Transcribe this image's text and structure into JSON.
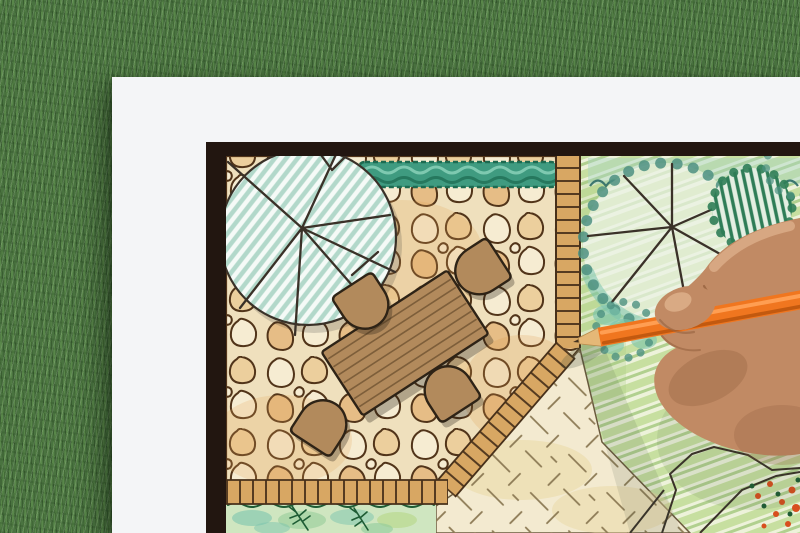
{
  "scene": {
    "subject": "hand drawing a backyard garden landscape architecture plan with an orange colored pencil",
    "setting": "white paper sheet lying on green grass lawn",
    "drawing_elements": {
      "tree_left": "large round tree symbol with teal hatching and branch lines",
      "hedge_top": "clipped hedge strip in teal green",
      "patio": "irregular flagstone patio",
      "furniture": "rectangular wooden table with four rounded chairs",
      "edging": "brick soldier-course edging bands around patio",
      "lawn_right": "striped colored-pencil lawn",
      "tree_right": "tree symbol with scalloped canopy and radiating branches",
      "shrub_right": "dark green hatched shrub symbol",
      "sand_area": "pale gravel area with diagonal tick marks",
      "bed_bottom": "planting bed with ferns",
      "flower_bed": "corner bed with small red-orange blooms"
    },
    "photo_props": {
      "pencil": "orange colored pencil",
      "hand": "right hand gripping pencil from the right edge"
    }
  },
  "colors": {
    "grass-base": "#4a7340",
    "paper": "#f4f5f7",
    "frame": "#221610",
    "plan-base": "#f8f3e2",
    "ink-brown": "#513419",
    "stone-cream": "#f6ecd2",
    "stone-tan": "#eccf9d",
    "stone-warm": "#e6bd86",
    "stone-grout": "#efe0bd",
    "wood": "#b28a5c",
    "wood-line": "#7d5e3a",
    "wood-dark": "#2e2316",
    "brick-fill": "#d8a763",
    "brick-line": "#47301a",
    "hedge": "#3f9b80",
    "hedge-dark": "#1d6a50",
    "hedge-light": "#8fd4bb",
    "tree-fill": "#f5faf7",
    "tree-hatch": "#b2d8ca",
    "spoke": "#3a3128",
    "canopy-teal": "#4d9181",
    "canopy-wash": "#a8d4c4",
    "shrub-dark": "#2f7d57",
    "lawn-a": "#c7dfa0",
    "lawn-b": "#edf2da",
    "lawn-c": "#a3c87b",
    "sand": "#f3ead0",
    "sand-mark": "#8d7b56",
    "bed-green": "#cfe6c0",
    "bed-teal": "#7cc4ae",
    "bed-leaf": "#1e5c34",
    "flower": "#d84f1e",
    "pencil-orange": "#f0761f",
    "pencil-light": "#ff9e52",
    "pencil-dark": "#c2590f",
    "pencil-wood": "#e5b877",
    "pencil-lead": "#43311f",
    "skin": "#c18a64",
    "skin-light": "#eabf9a",
    "skin-dark": "#8f5c3b",
    "shadow": "#3c4a38"
  }
}
